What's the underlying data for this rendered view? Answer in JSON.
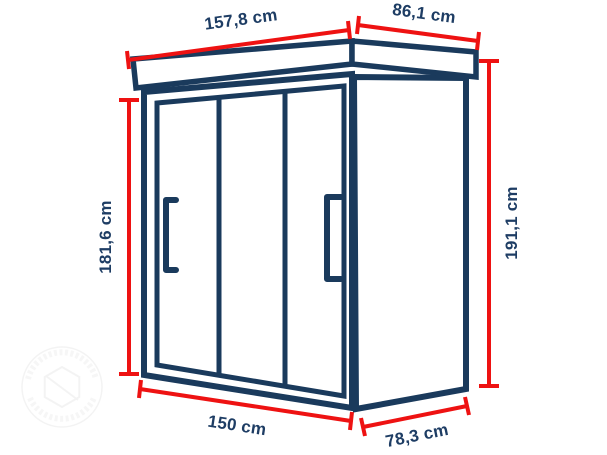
{
  "diagram": {
    "dimensions": {
      "top_width": "157,8 cm",
      "top_depth": "86,1 cm",
      "left_height": "181,6 cm",
      "right_height": "191,1 cm",
      "bottom_width": "150 cm",
      "bottom_depth": "78,3 cm"
    },
    "icons": {
      "watermark": "circular-stamp-logo"
    },
    "colors": {
      "outline_navy": "#1A3A5C",
      "dimension_red": "#EE1212",
      "label_navy": "#1E3D64",
      "background": "#FFFFFF"
    }
  }
}
